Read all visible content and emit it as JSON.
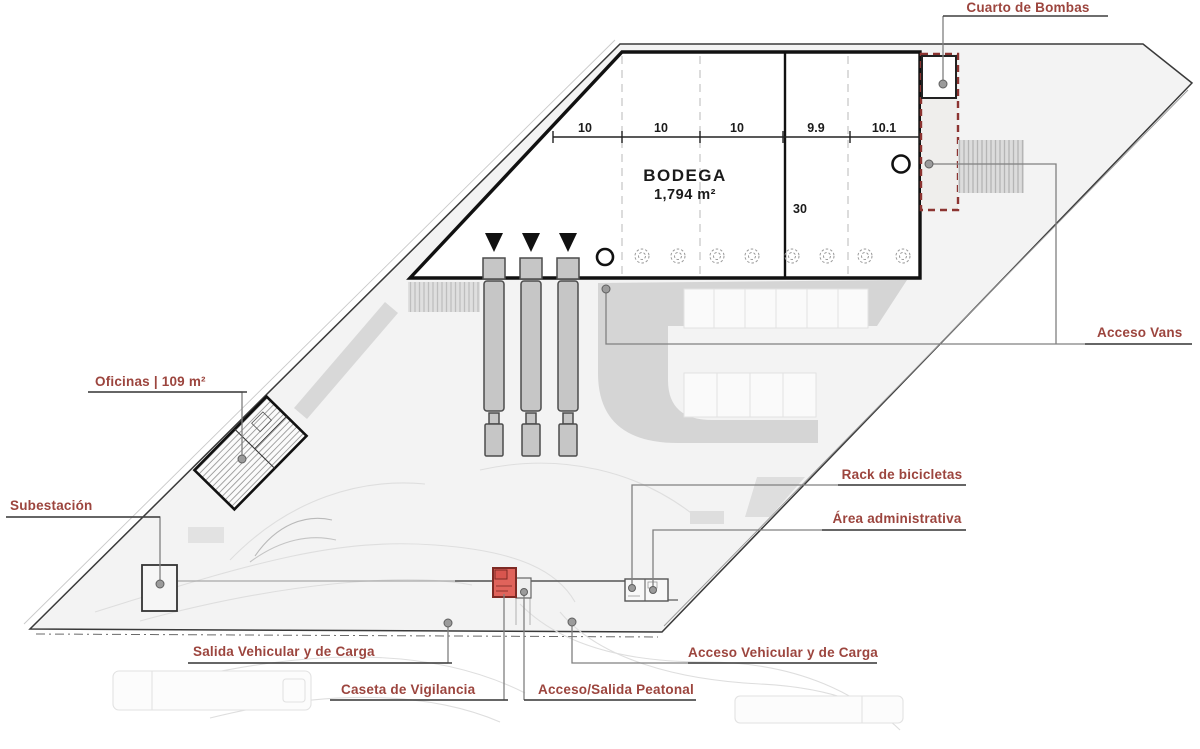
{
  "plan": {
    "title": "BODEGA",
    "building_label": {
      "title": "BODEGA",
      "area": "1,794 m²"
    },
    "dimensions": {
      "bays": [
        "10",
        "10",
        "10",
        "9.9",
        "10.1"
      ],
      "depth": "30"
    },
    "labels": {
      "cuarto_de_bombas": "Cuarto de Bombas",
      "acceso_vans": "Acceso Vans",
      "oficinas": "Oficinas | 109 m²",
      "subestacion": "Subestación",
      "rack_bicicletas": "Rack de bicicletas",
      "area_administrativa": "Área administrativa",
      "salida_vehicular": "Salida Vehicular y de Carga",
      "caseta_vigilancia": "Caseta de Vigilancia",
      "acceso_peatonal": "Acceso/Salida Peatonal",
      "acceso_vehicular": "Acceso Vehicular y de Carga"
    },
    "colors": {
      "label_text": "#9c453e",
      "underline": "#3f3f3f",
      "leader_line": "#808080",
      "outline": "#1a1a1a",
      "site_fill": "#f3f3f3",
      "parking_fill": "#d5d5d5",
      "truck_fill": "#c6c6c6",
      "caseta_fill": "#e0635b",
      "caseta_border": "#7e2a24",
      "dashed_zone_border": "#8c3431"
    }
  }
}
